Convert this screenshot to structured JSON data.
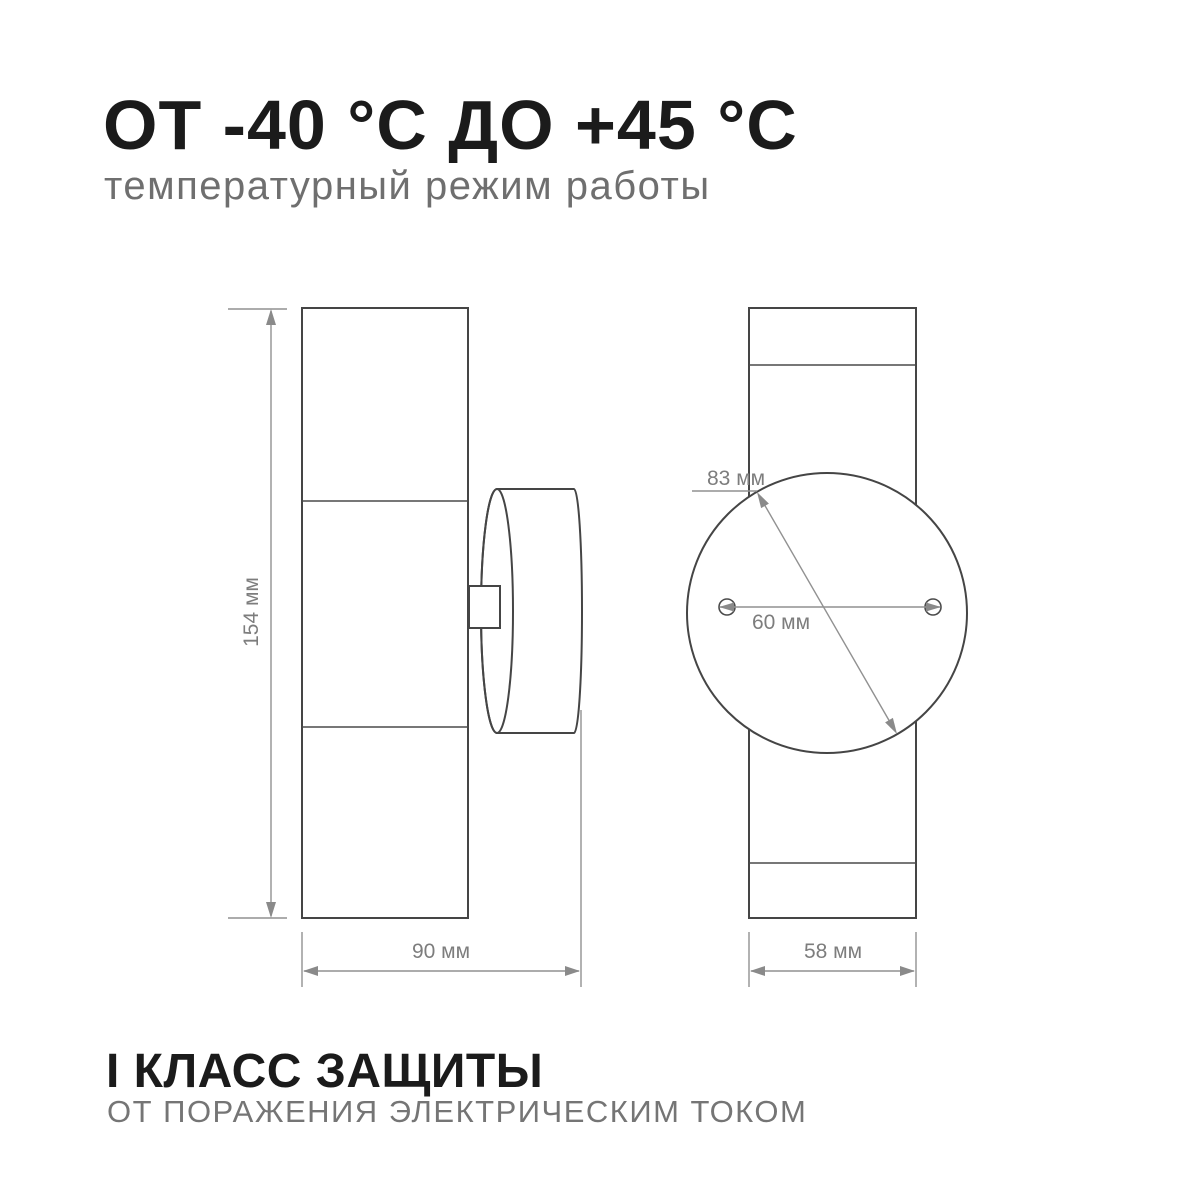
{
  "header": {
    "title": "ОТ -40 °С ДО +45 °С",
    "subtitle": "температурный режим работы"
  },
  "footer": {
    "title": "I КЛАСС ЗАЩИТЫ",
    "subtitle": "ОТ ПОРАЖЕНИЯ ЭЛЕКТРИЧЕСКИМ ТОКОМ"
  },
  "dimensions": {
    "height": "154 мм",
    "body_width": "90 мм",
    "plate_diameter": "83 мм",
    "hole_spacing": "60 мм",
    "side_width": "58 мм"
  },
  "colors": {
    "outline": "#454545",
    "dimension_lines": "#919191",
    "dimension_text": "#7d7d7d",
    "heading_text": "#1b1b1b",
    "subtitle_text": "#6f6f6f"
  }
}
